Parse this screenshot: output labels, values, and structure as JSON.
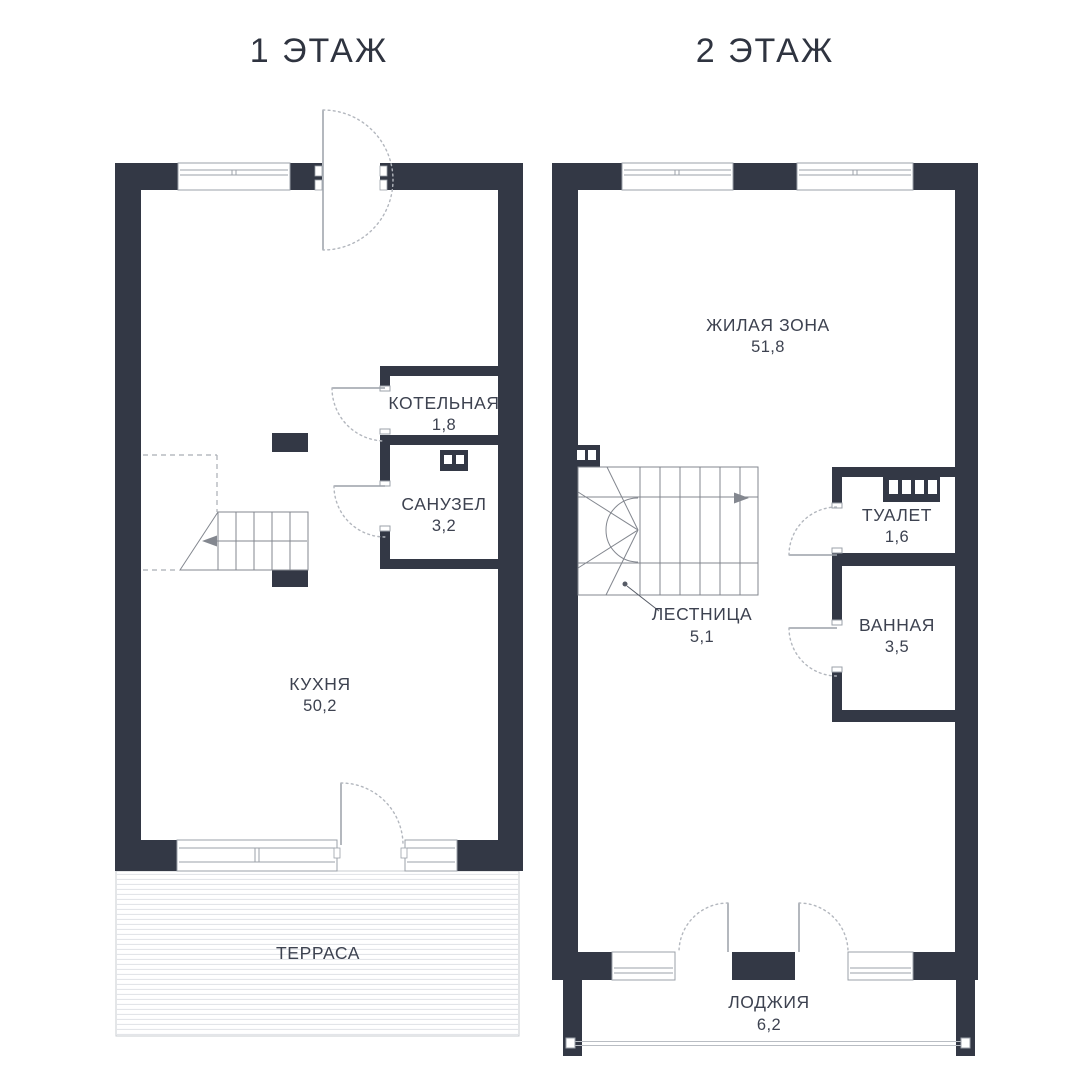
{
  "floor1": {
    "title": "1 ЭТАЖ",
    "rooms": {
      "boiler": {
        "name": "КОТЕЛЬНАЯ",
        "area": "1,8"
      },
      "sanuzel": {
        "name": "САНУЗЕЛ",
        "area": "3,2"
      },
      "kitchen": {
        "name": "КУХНЯ",
        "area": "50,2"
      },
      "terrace": {
        "name": "ТЕРРАСА"
      }
    }
  },
  "floor2": {
    "title": "2 ЭТАЖ",
    "rooms": {
      "living": {
        "name": "ЖИЛАЯ ЗОНА",
        "area": "51,8"
      },
      "stairs": {
        "name": "ЛЕСТНИЦА",
        "area": "5,1"
      },
      "toilet": {
        "name": "ТУАЛЕТ",
        "area": "1,6"
      },
      "bath": {
        "name": "ВАННАЯ",
        "area": "3,5"
      },
      "loggia": {
        "name": "ЛОДЖИЯ",
        "area": "6,2"
      }
    }
  },
  "colors": {
    "wall": "#333845",
    "text": "#3d4250",
    "frame_line": "#9ba1a9",
    "stair_line": "#83878f",
    "door_swing": "#b3b7be",
    "terrace_hatch": "#e3e5e9"
  }
}
